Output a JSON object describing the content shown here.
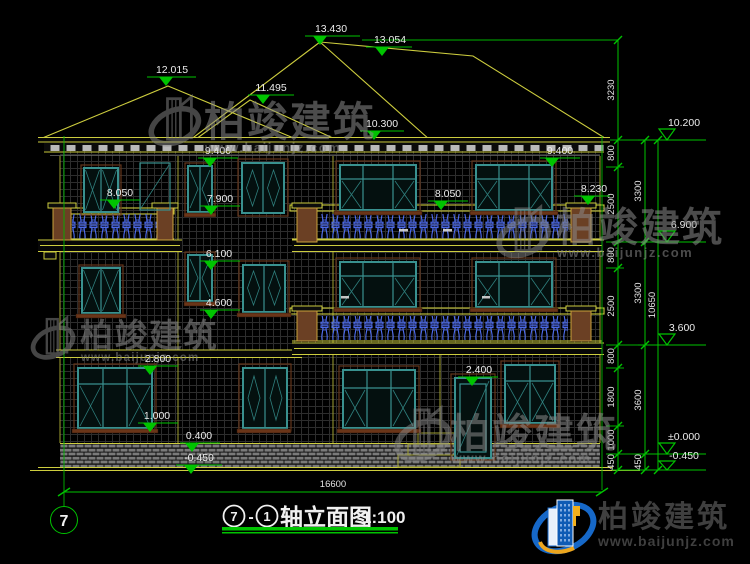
{
  "drawing": {
    "title": {
      "axis_start": "7",
      "separator": "-",
      "axis_end": "1",
      "name": "轴立面图",
      "scale": "1:100"
    },
    "axis_bubble_left": "7",
    "overall_width_mm": "16600",
    "elevation_markers": {
      "roof_peak": "13.430",
      "roof_ridge": "13.054",
      "left_roof_peak": "12.015",
      "roof_valley": "11.495",
      "porch_roof_eave": "10.300",
      "eave_left": "9.400",
      "eave_right": "9.400",
      "balcony3_left": "8.050",
      "balcony3_right": "8.050",
      "window3_mid": "7.900",
      "balcony3_pillar": "8.230",
      "stair_window_head": "6.100",
      "stair_window_sill": "4.600",
      "window1_head": "2.800",
      "window1_sill": "1.000",
      "plinth_top": "0.400",
      "ground": "-0.450",
      "door_head": "2.400"
    },
    "right_levels": {
      "l1": "10.200",
      "l2": "6.900",
      "l3": "3.600",
      "l4": "±0.000",
      "l5": "-0.450"
    },
    "dim_inner": [
      "3230",
      "800",
      "2500",
      "800",
      "2500",
      "800",
      "1800",
      "1000",
      "450"
    ],
    "dim_mid": [
      "3300",
      "3300",
      "3600",
      "450"
    ],
    "dim_total": "10650"
  },
  "watermark": {
    "brand": "柏竣建筑",
    "site": "www.baijunjz.com"
  },
  "logo": {
    "brand": "柏竣建筑",
    "site": "www.baijunjz.com"
  }
}
